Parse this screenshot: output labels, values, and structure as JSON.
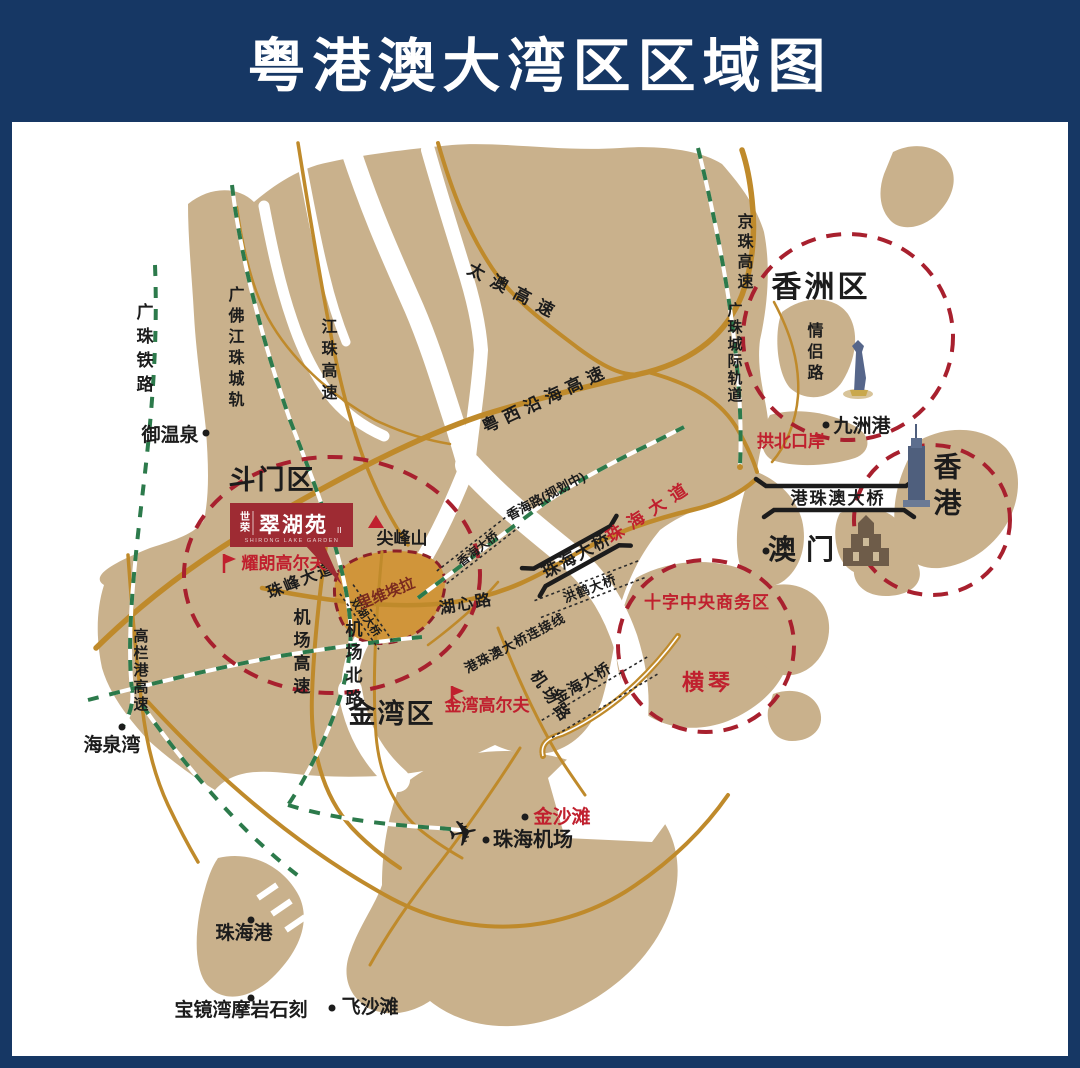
{
  "title": "粤港澳大湾区区域图",
  "colors": {
    "frame": "#163764",
    "map_background": "#ffffff",
    "land": "#c9b18c",
    "road": "#bf8a2b",
    "railway_green": "#2c7a4b",
    "zone_circle_red": "#a8202e",
    "highlight_red_text": "#c0202e",
    "black_text": "#1c1c1c",
    "project_banner": "#9e2b33",
    "riviera_fill": "#d0953a"
  },
  "logo": {
    "brand": "世荣",
    "name": "翠湖苑",
    "suffix": "II",
    "subtitle": "SHIRONG LAKE GARDEN"
  },
  "labels": {
    "doumen": "斗门区",
    "jinwan": "金湾区",
    "xiangzhou": "香洲区",
    "hongkong": "香港",
    "macau": "澳门",
    "hengqin": "横琴",
    "cbd": "十字中央商务区",
    "taiao": "太澳高速",
    "jiangzhu": "江珠高速",
    "yuexi": "粤西沿海高速",
    "jingzhu": "京珠高速",
    "gaolan": "高栏港高速",
    "jichang_gaosu": "机场高速",
    "jichang_beilu": "机场北路",
    "jichang_lu": "机场路",
    "zhufeng": "珠峰大道",
    "zhuhai_dadao": "珠海大道",
    "huxin": "湖心路",
    "qinglv": "情侣路",
    "xianghai_road": "香海路(规划中)",
    "lianjie": "港珠澳大桥连接线",
    "guangzhu_rail": "广珠铁路",
    "guangfo_rail": "广佛江珠城轨",
    "chengji_rail": "广珠城际轨道",
    "hzmb": "港珠澳大桥",
    "zhuhai_bridge": "珠海大桥",
    "honghe_bridge": "洪鹤大桥",
    "xianghai_bridge": "香海大桥",
    "shuanghu_bridge": "双湖大桥",
    "jinhai_bridge": "金海大桥",
    "yuwenquan": "御温泉",
    "jianfengshan": "尖峰山",
    "yaolang_golf": "耀朗高尔夫",
    "riviera": "里维埃拉",
    "jinwan_golf": "金湾高尔夫",
    "haiquanwan": "海泉湾",
    "jiuzhou": "九洲港",
    "gongbei": "拱北口岸",
    "jinshatan": "金沙滩",
    "airport": "珠海机场",
    "zhuhaigang": "珠海港",
    "baojing": "宝镜湾摩岩石刻",
    "feishatan": "飞沙滩"
  }
}
